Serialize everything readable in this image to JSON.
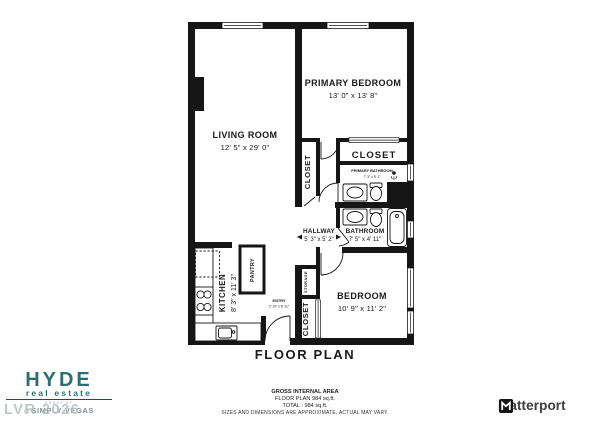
{
  "title": "FLOOR PLAN",
  "rooms": {
    "living_room": {
      "name": "LIVING ROOM",
      "dims": "12' 5\" x 29' 0\""
    },
    "primary_bedroom": {
      "name": "PRIMARY BEDROOM",
      "dims": "13' 0\" x 13' 8\""
    },
    "primary_closet": {
      "name": "CLOSET"
    },
    "primary_bathroom": {
      "name": "PRIMARY BATHROOM",
      "dims": "7' 3\" x 5' 1\""
    },
    "hall_closet": {
      "name": "CLOSET"
    },
    "hallway": {
      "name": "HALLWAY",
      "dims": "5' 3\" x 5' 2\""
    },
    "bathroom": {
      "name": "BATHROOM",
      "dims": "7' 5\" x 4' 11\""
    },
    "bedroom": {
      "name": "BEDROOM",
      "dims": "10' 9\" x 11' 2\""
    },
    "storage": {
      "name": "STORAGE"
    },
    "bedroom_closet": {
      "name": "CLOSET"
    },
    "entry": {
      "name": "ENTRY",
      "dims": "2' 10\" x 8' 11\""
    },
    "kitchen": {
      "name": "KITCHEN",
      "dims": "8' 3\" x 11' 3\""
    },
    "pantry": {
      "name": "PANTRY"
    }
  },
  "footer": {
    "line1": "GROSS INTERNAL AREA",
    "line2": "FLOOR PLAN 984 sq.ft.",
    "line3": "TOTAL :  984 sq.ft.",
    "line4": "SIZES AND DIMENSIONS ARE APPROXIMATE, ACTUAL MAY VARY."
  },
  "branding": {
    "agency_name": "HYDE",
    "agency_sub": "real estate",
    "agency_group": "GROUP AT",
    "agency_brand": "SIMPLY VEGAS",
    "watermark": "LVR 2026",
    "provider": "Matterport"
  },
  "colors": {
    "wall": "#161616",
    "accent_teal": "#2d6e73",
    "brand_gray": "#7e9597",
    "watermark_gray": "#b7c3c3",
    "provider_text": "#3d3d3d"
  }
}
